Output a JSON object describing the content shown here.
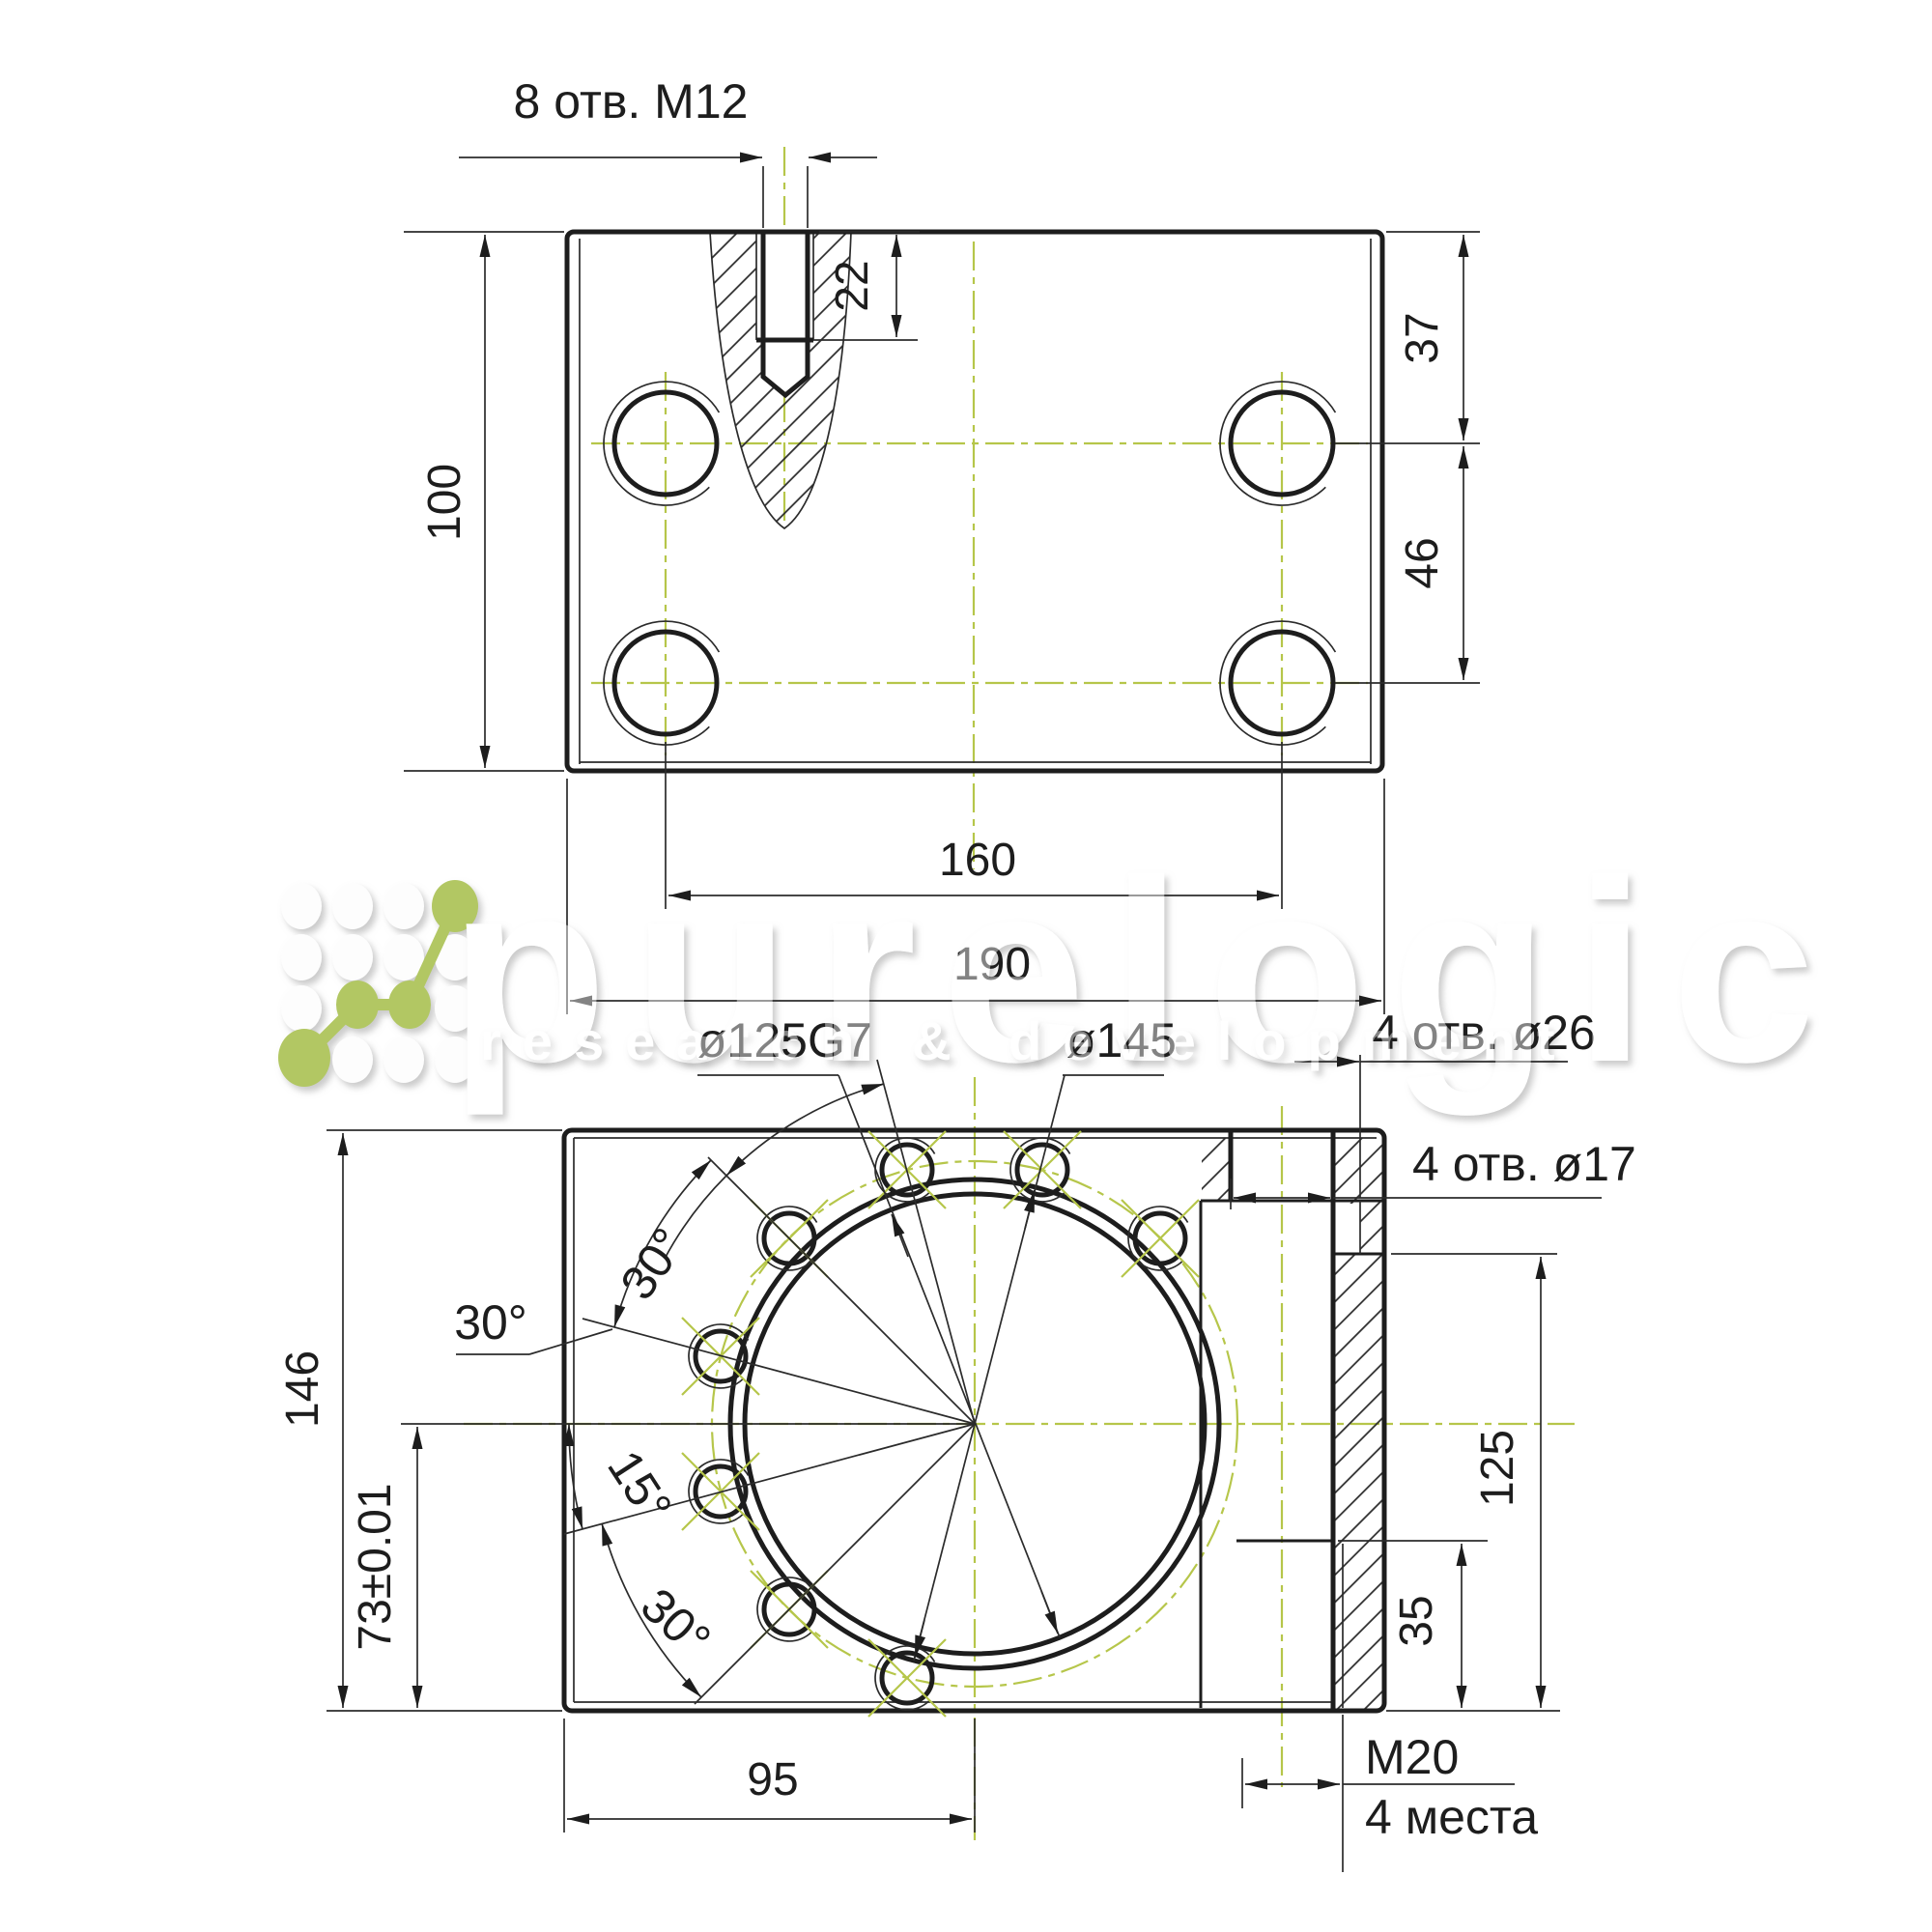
{
  "watermark": {
    "brand": "purelogic",
    "tagline": "research & development",
    "logo_green": "#b2c763"
  },
  "colors": {
    "line": "#1d1d1d",
    "centerline": "#b6c64a",
    "dimension_text": "#1d1d1d"
  },
  "top_view": {
    "dims": {
      "m12": "8 отв. M12",
      "depth22": "22",
      "d37": "37",
      "d46": "46",
      "d100": "100",
      "d160": "160",
      "d190": "190"
    }
  },
  "bottom_view": {
    "dims": {
      "bore": "ø125G7",
      "outer": "ø145",
      "holes26": "4 отв. ø26",
      "holes17": "4 отв. ø17",
      "a30a": "30°",
      "a30b": "30°",
      "a30c": "30°",
      "a15": "15°",
      "d146": "146",
      "d73": "73±0.01",
      "d125": "125",
      "d35": "35",
      "d95": "95",
      "m20": "M20",
      "m20qty": "4 места"
    }
  }
}
